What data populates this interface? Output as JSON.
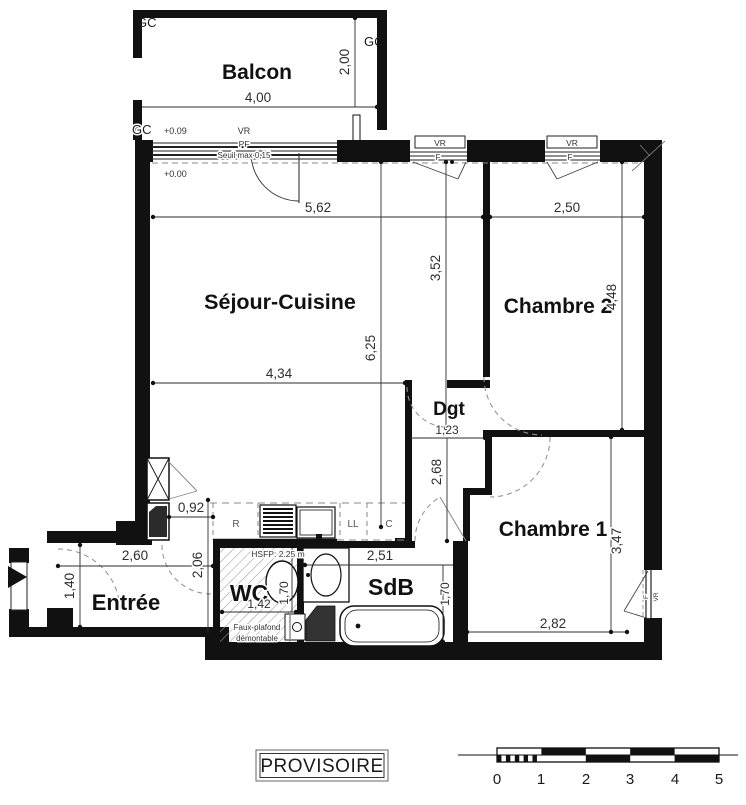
{
  "status_label": "PROVISOIRE",
  "rooms": {
    "balcon": "Balcon",
    "sejour": "Séjour-Cuisine",
    "chambre2": "Chambre 2",
    "chambre1": "Chambre 1",
    "dgt": "Dgt",
    "wc": "WC",
    "sdb": "SdB",
    "entree": "Entrée"
  },
  "dims": {
    "balcon_w": "4,00",
    "balcon_d": "2,00",
    "sejour_w": "5,62",
    "ch2_w": "2,50",
    "sejour_h": "6,25",
    "sejour_mid_h": "3,52",
    "ch2_h": "4,48",
    "sejour_low_w": "4,34",
    "dgt_w": "1,23",
    "dgt_h": "2,68",
    "passage_w": "0,92",
    "entree_w": "2,60",
    "entree_d": "1,40",
    "wc_out_h": "2,06",
    "wc_w": "1,42",
    "wc_d": "1,70",
    "sdb_w": "2,51",
    "sdb_d": "1,70",
    "ch1_w": "2,82",
    "ch1_h": "3,47"
  },
  "annot": {
    "gc1": "GC",
    "gc2": "GC",
    "gc3": "GC",
    "lvl_balcon": "+0.09",
    "lvl_floor": "+0.00",
    "vr_pf": "VR",
    "pf": "PF",
    "seuil": "Seuil max 0,15",
    "vr1": "VR",
    "f1": "F",
    "vr2": "VR",
    "f2": "F",
    "vr3": "VR",
    "f3": "F",
    "fridge": "R",
    "washer": "LL",
    "closet": "C",
    "hsfp": "HSFP: 2.25 m",
    "fp1": "Faux-plafond",
    "fp2": "démontable"
  },
  "scale": {
    "ticks": [
      "0",
      "1",
      "2",
      "3",
      "4",
      "5"
    ]
  },
  "colors": {
    "ink": "#1a1a1a",
    "dash": "#969696",
    "dim": "#2e2e2e"
  }
}
